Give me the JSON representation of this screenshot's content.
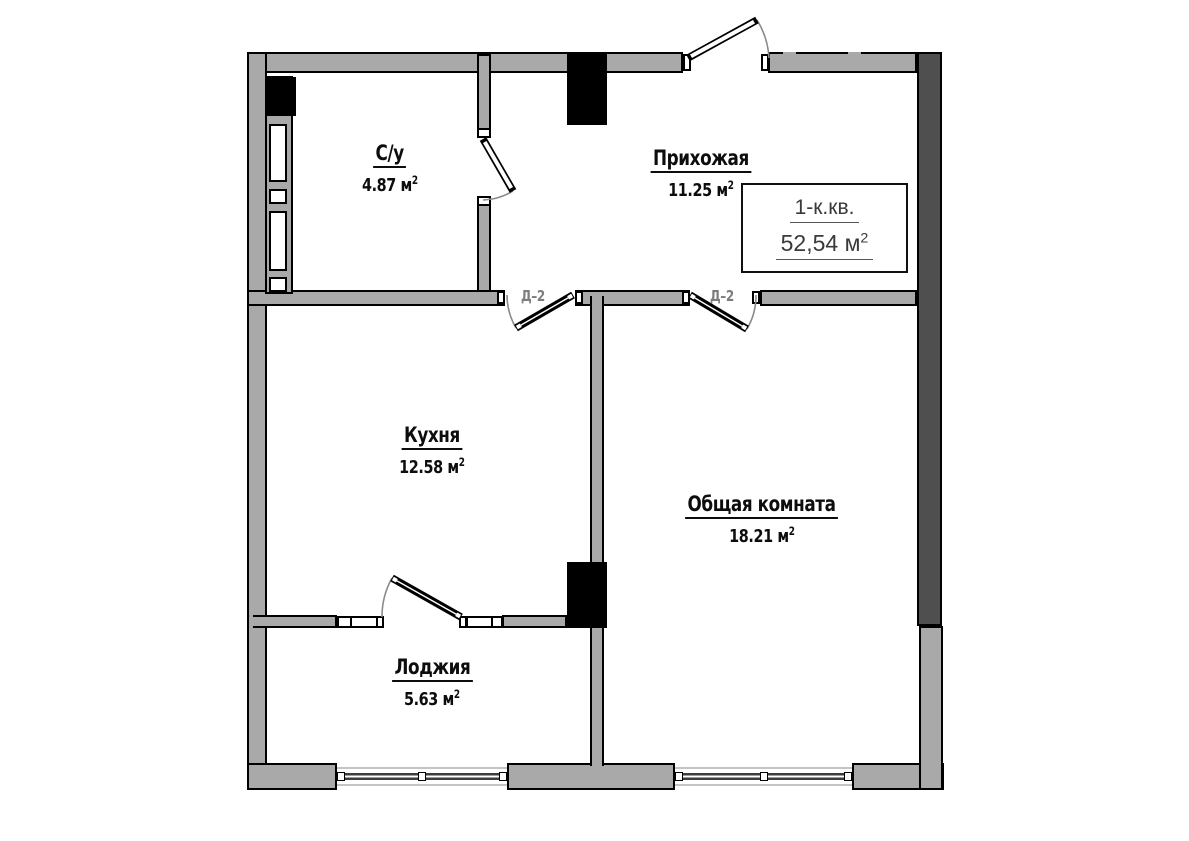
{
  "plan": {
    "title_box": {
      "line1": "1-к.кв.",
      "line2": "52,54 м",
      "sup": "2"
    },
    "rooms": [
      {
        "id": "bathroom",
        "name": "С/у",
        "area": "4.87 м",
        "sup": "2"
      },
      {
        "id": "hallway",
        "name": "Прихожая",
        "area": "11.25 м",
        "sup": "2"
      },
      {
        "id": "kitchen",
        "name": "Кухня",
        "area": "12.58 м",
        "sup": "2"
      },
      {
        "id": "living-room",
        "name": "Общая комната",
        "area": "18.21 м",
        "sup": "2"
      },
      {
        "id": "loggia",
        "name": "Лоджия",
        "area": "5.63 м",
        "sup": "2"
      }
    ],
    "door_labels": {
      "kitchen": "Д–2",
      "living": "Д–2"
    },
    "colors": {
      "wall": "#a9a9a9",
      "wall_dark": "#4f4f4f",
      "outline": "#000000",
      "door_label": "#7d7d7d",
      "swing_arc": "#8a8a8a"
    }
  }
}
